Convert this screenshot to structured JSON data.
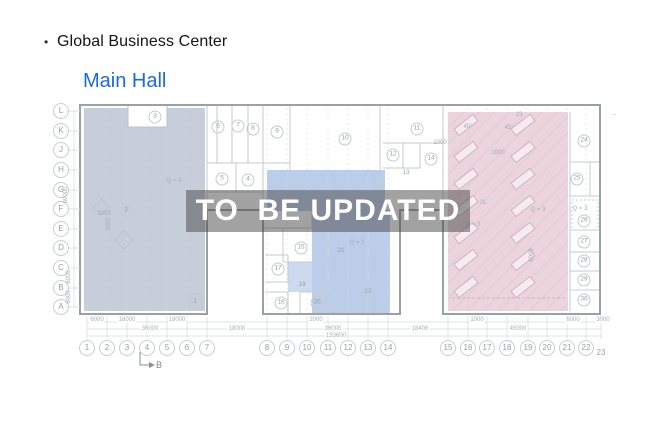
{
  "header": {
    "bullet": "•",
    "title": "Global Business Center"
  },
  "link": {
    "label": "Main Hall",
    "color": "#1c6bd5"
  },
  "watermark": {
    "text": "TO  BE UPDATED",
    "bg": "rgba(70,70,70,0.5)",
    "fg": "#ffffff"
  },
  "plan": {
    "regions": {
      "left_fill": "#c7ceda",
      "middle_fill": "#bccdea",
      "middle_light_fill": "#cdd9ef",
      "right_fill": "#ecd4dd"
    },
    "b_marker": "B",
    "axis_letters": [
      {
        "n": "L",
        "y": 111
      },
      {
        "n": "K",
        "y": 131
      },
      {
        "n": "J",
        "y": 150
      },
      {
        "n": "H",
        "y": 170
      },
      {
        "n": "G",
        "y": 190
      },
      {
        "n": "F",
        "y": 209
      },
      {
        "n": "E",
        "y": 229
      },
      {
        "n": "D",
        "y": 248
      },
      {
        "n": "C",
        "y": 268
      },
      {
        "n": "B",
        "y": 288
      },
      {
        "n": "A",
        "y": 307
      }
    ],
    "axis_numbers": [
      {
        "n": "1",
        "x": 87
      },
      {
        "n": "2",
        "x": 107
      },
      {
        "n": "3",
        "x": 127
      },
      {
        "n": "4",
        "x": 147
      },
      {
        "n": "5",
        "x": 167
      },
      {
        "n": "6",
        "x": 187
      },
      {
        "n": "7",
        "x": 207
      },
      {
        "n": "8",
        "x": 267
      },
      {
        "n": "9",
        "x": 287
      },
      {
        "n": "10",
        "x": 307
      },
      {
        "n": "11",
        "x": 328
      },
      {
        "n": "12",
        "x": 348
      },
      {
        "n": "13",
        "x": 368
      },
      {
        "n": "14",
        "x": 388
      },
      {
        "n": "15",
        "x": 448
      },
      {
        "n": "16",
        "x": 468
      },
      {
        "n": "17",
        "x": 487
      },
      {
        "n": "18",
        "x": 507
      },
      {
        "n": "19",
        "x": 528
      },
      {
        "n": "20",
        "x": 547
      },
      {
        "n": "21",
        "x": 567
      },
      {
        "n": "22",
        "x": 586
      },
      {
        "n": "23",
        "x": 601,
        "y": 353,
        "c": 0
      }
    ],
    "rooms": [
      {
        "n": "1",
        "x": 195,
        "y": 302,
        "c": 1
      },
      {
        "n": "2",
        "x": 126,
        "y": 211,
        "c": 1
      },
      {
        "n": "3",
        "x": 155,
        "y": 117,
        "c": 1
      },
      {
        "n": "4",
        "x": 248,
        "y": 180,
        "c": 1
      },
      {
        "n": "5",
        "x": 222,
        "y": 179,
        "c": 1
      },
      {
        "n": "6",
        "x": 218,
        "y": 127,
        "c": 1
      },
      {
        "n": "7",
        "x": 238,
        "y": 126,
        "c": 1
      },
      {
        "n": "8",
        "x": 253,
        "y": 129,
        "c": 1
      },
      {
        "n": "9",
        "x": 277,
        "y": 132,
        "c": 1
      },
      {
        "n": "10",
        "x": 345,
        "y": 139,
        "c": 1
      },
      {
        "n": "11",
        "x": 417,
        "y": 129,
        "c": 1
      },
      {
        "n": "12",
        "x": 393,
        "y": 155,
        "c": 1
      },
      {
        "n": "13",
        "x": 406,
        "y": 173,
        "c": 0
      },
      {
        "n": "14",
        "x": 431,
        "y": 159,
        "c": 1
      },
      {
        "n": "15",
        "x": 301,
        "y": 248,
        "c": 1
      },
      {
        "n": "17",
        "x": 278,
        "y": 269,
        "c": 1
      },
      {
        "n": "18",
        "x": 281,
        "y": 303,
        "c": 1
      },
      {
        "n": "19",
        "x": 302,
        "y": 285,
        "c": 0
      },
      {
        "n": "20",
        "x": 317,
        "y": 303,
        "c": 1
      },
      {
        "n": "21",
        "x": 341,
        "y": 251,
        "c": 0
      },
      {
        "n": "22",
        "x": 368,
        "y": 292,
        "c": 0
      },
      {
        "n": "24",
        "x": 584,
        "y": 141,
        "c": 1
      },
      {
        "n": "25",
        "x": 577,
        "y": 179,
        "c": 1
      },
      {
        "n": "26",
        "x": 584,
        "y": 221,
        "c": 1
      },
      {
        "n": "27",
        "x": 584,
        "y": 242,
        "c": 1
      },
      {
        "n": "28",
        "x": 584,
        "y": 261,
        "c": 1
      },
      {
        "n": "29",
        "x": 584,
        "y": 280,
        "c": 1
      },
      {
        "n": "30",
        "x": 584,
        "y": 300,
        "c": 1
      }
    ],
    "dimensions": [
      {
        "t": "6000",
        "x": 97,
        "y": 320
      },
      {
        "t": "18000",
        "x": 127,
        "y": 320
      },
      {
        "t": "18000",
        "x": 177,
        "y": 320
      },
      {
        "t": "2000",
        "x": 316,
        "y": 320
      },
      {
        "t": "1000",
        "x": 477,
        "y": 320
      },
      {
        "t": "6000",
        "x": 573,
        "y": 320
      },
      {
        "t": "3000",
        "x": 603,
        "y": 320
      },
      {
        "t": "36000",
        "x": 150,
        "y": 329
      },
      {
        "t": "18000",
        "x": 237,
        "y": 329
      },
      {
        "t": "36000",
        "x": 333,
        "y": 329
      },
      {
        "t": "18400",
        "x": 420,
        "y": 329
      },
      {
        "t": "45000",
        "x": 518,
        "y": 329
      },
      {
        "t": "153600",
        "x": 336,
        "y": 336
      },
      {
        "t": "2000",
        "x": 104,
        "y": 214
      },
      {
        "t": "1000",
        "x": 498,
        "y": 153
      },
      {
        "t": "1000",
        "x": 440,
        "y": 143
      },
      {
        "t": "60000",
        "x": 66,
        "y": 195,
        "rot": true
      },
      {
        "t": "6000",
        "x": 69,
        "y": 277,
        "rot": true
      },
      {
        "t": "6000",
        "x": 69,
        "y": 297,
        "rot": true
      },
      {
        "t": "3000",
        "x": 109,
        "y": 224,
        "rot": true
      },
      {
        "t": "6000",
        "x": 532,
        "y": 255,
        "rot": true
      }
    ],
    "annotations": [
      {
        "t": "Q = 3",
        "x": 174,
        "y": 181
      },
      {
        "t": "Q = 3",
        "x": 357,
        "y": 243
      },
      {
        "t": "Q = 3",
        "x": 473,
        "y": 225
      },
      {
        "t": "Q = 3",
        "x": 538,
        "y": 210
      },
      {
        "t": "Q = 3",
        "x": 580,
        "y": 209
      },
      {
        "t": "45°",
        "x": 468,
        "y": 127
      },
      {
        "t": "45°",
        "x": 509,
        "y": 128
      },
      {
        "t": "23",
        "x": 519,
        "y": 115
      },
      {
        "t": "31",
        "x": 483,
        "y": 203
      },
      {
        "t": "–",
        "x": 614,
        "y": 115
      }
    ]
  }
}
